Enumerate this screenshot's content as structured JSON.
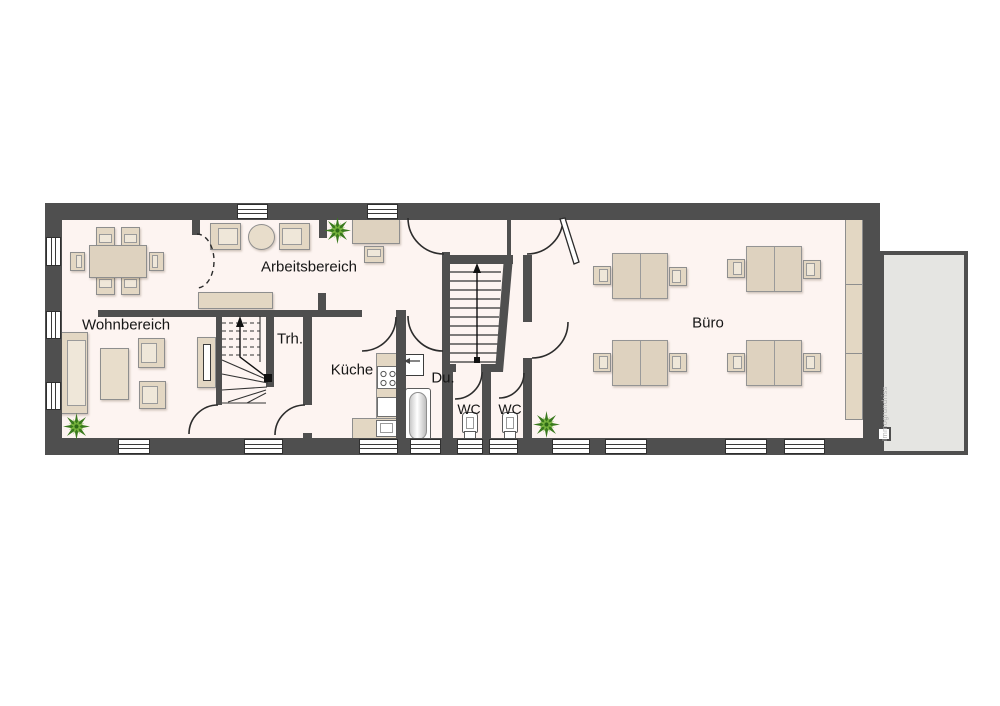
{
  "floorplan": {
    "rooms": {
      "wohnbereich": {
        "label": "Wohnbereich"
      },
      "arbeitsbereich": {
        "label": "Arbeitsbereich"
      },
      "treppenhaus": {
        "label": "Trh."
      },
      "kueche": {
        "label": "Küche"
      },
      "dusche": {
        "label": "Du."
      },
      "wc1": {
        "label": "WC"
      },
      "wc2": {
        "label": "WC"
      },
      "buero": {
        "label": "Büro"
      }
    },
    "watermark": "Immogrundriss",
    "colors": {
      "wall": "#4f4f4f",
      "floor": "#fdf4f1",
      "furniture": "#e3d7c3",
      "terrace": "#e5e5e2",
      "plant_dark": "#3a7a1e",
      "plant_light": "#79b53e"
    }
  }
}
